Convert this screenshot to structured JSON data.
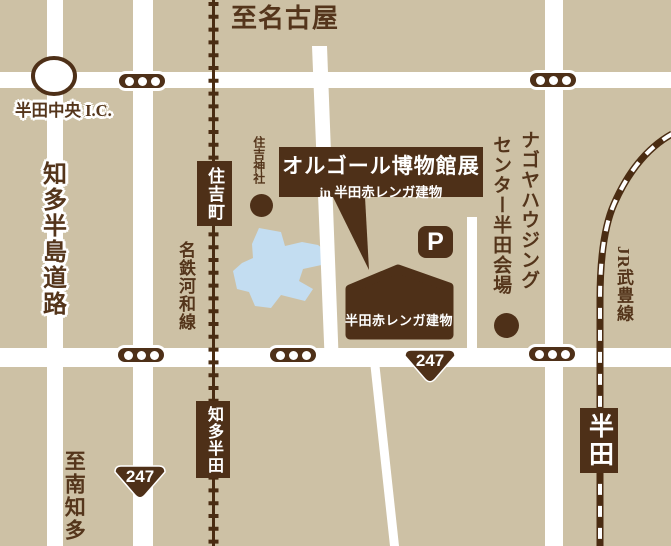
{
  "colors": {
    "background": "#cdc1a5",
    "brown": "#4e3018",
    "road": "#ffffff",
    "water": "#c3ddf1",
    "text": "#54351b"
  },
  "destinations": {
    "to_nagoya": "至名古屋",
    "to_minami_chita": "至南知多"
  },
  "expressway": {
    "name": "知多半島道路",
    "interchange": "半田中央 I.C."
  },
  "railways": {
    "meitetsu": "名鉄河和線",
    "jr": "JR武豊線"
  },
  "stations": {
    "sumiyoshicho": "住吉町",
    "chita_handa": "知多半田",
    "handa": "半田"
  },
  "callout": {
    "line1": "オルゴール博物館展",
    "line2": "in 半田赤レンガ建物"
  },
  "building": {
    "name": "半田赤レンガ建物"
  },
  "shrine": {
    "name": "住吉神社"
  },
  "housing_center": {
    "line1": "ナゴヤハウジング",
    "line2": "センター半田会場"
  },
  "parking": {
    "label": "P"
  },
  "route_badges": [
    {
      "number": "247"
    },
    {
      "number": "247"
    }
  ]
}
